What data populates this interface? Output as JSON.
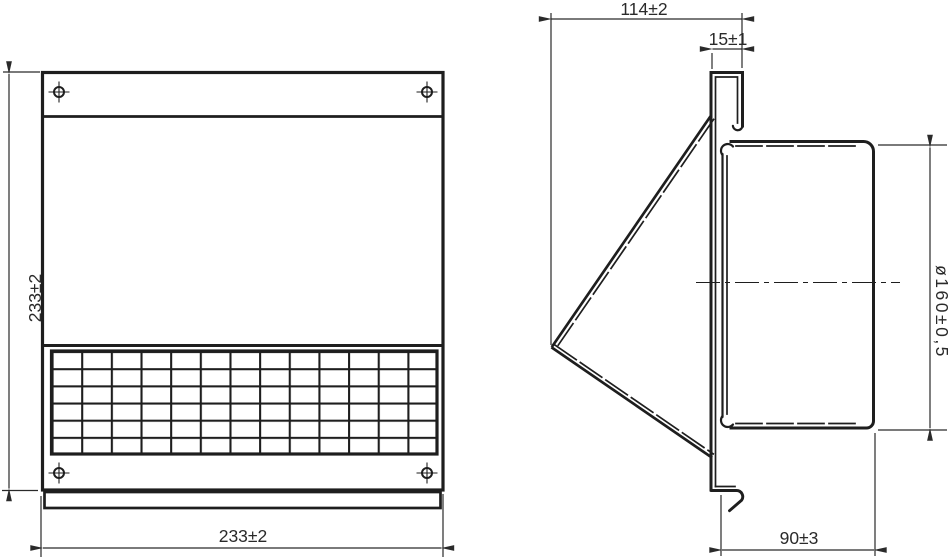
{
  "colors": {
    "line": "#1e1e1e",
    "dim": "#2a2a2a",
    "background": "#ffffff"
  },
  "front_view": {
    "height_dim": "233±2",
    "width_dim": "233±2"
  },
  "side_view": {
    "depth_dim": "114±2",
    "top_flange_dim": "15±1",
    "duct_diameter_dim": "ø160±0,5",
    "duct_length_dim": "90±3"
  }
}
